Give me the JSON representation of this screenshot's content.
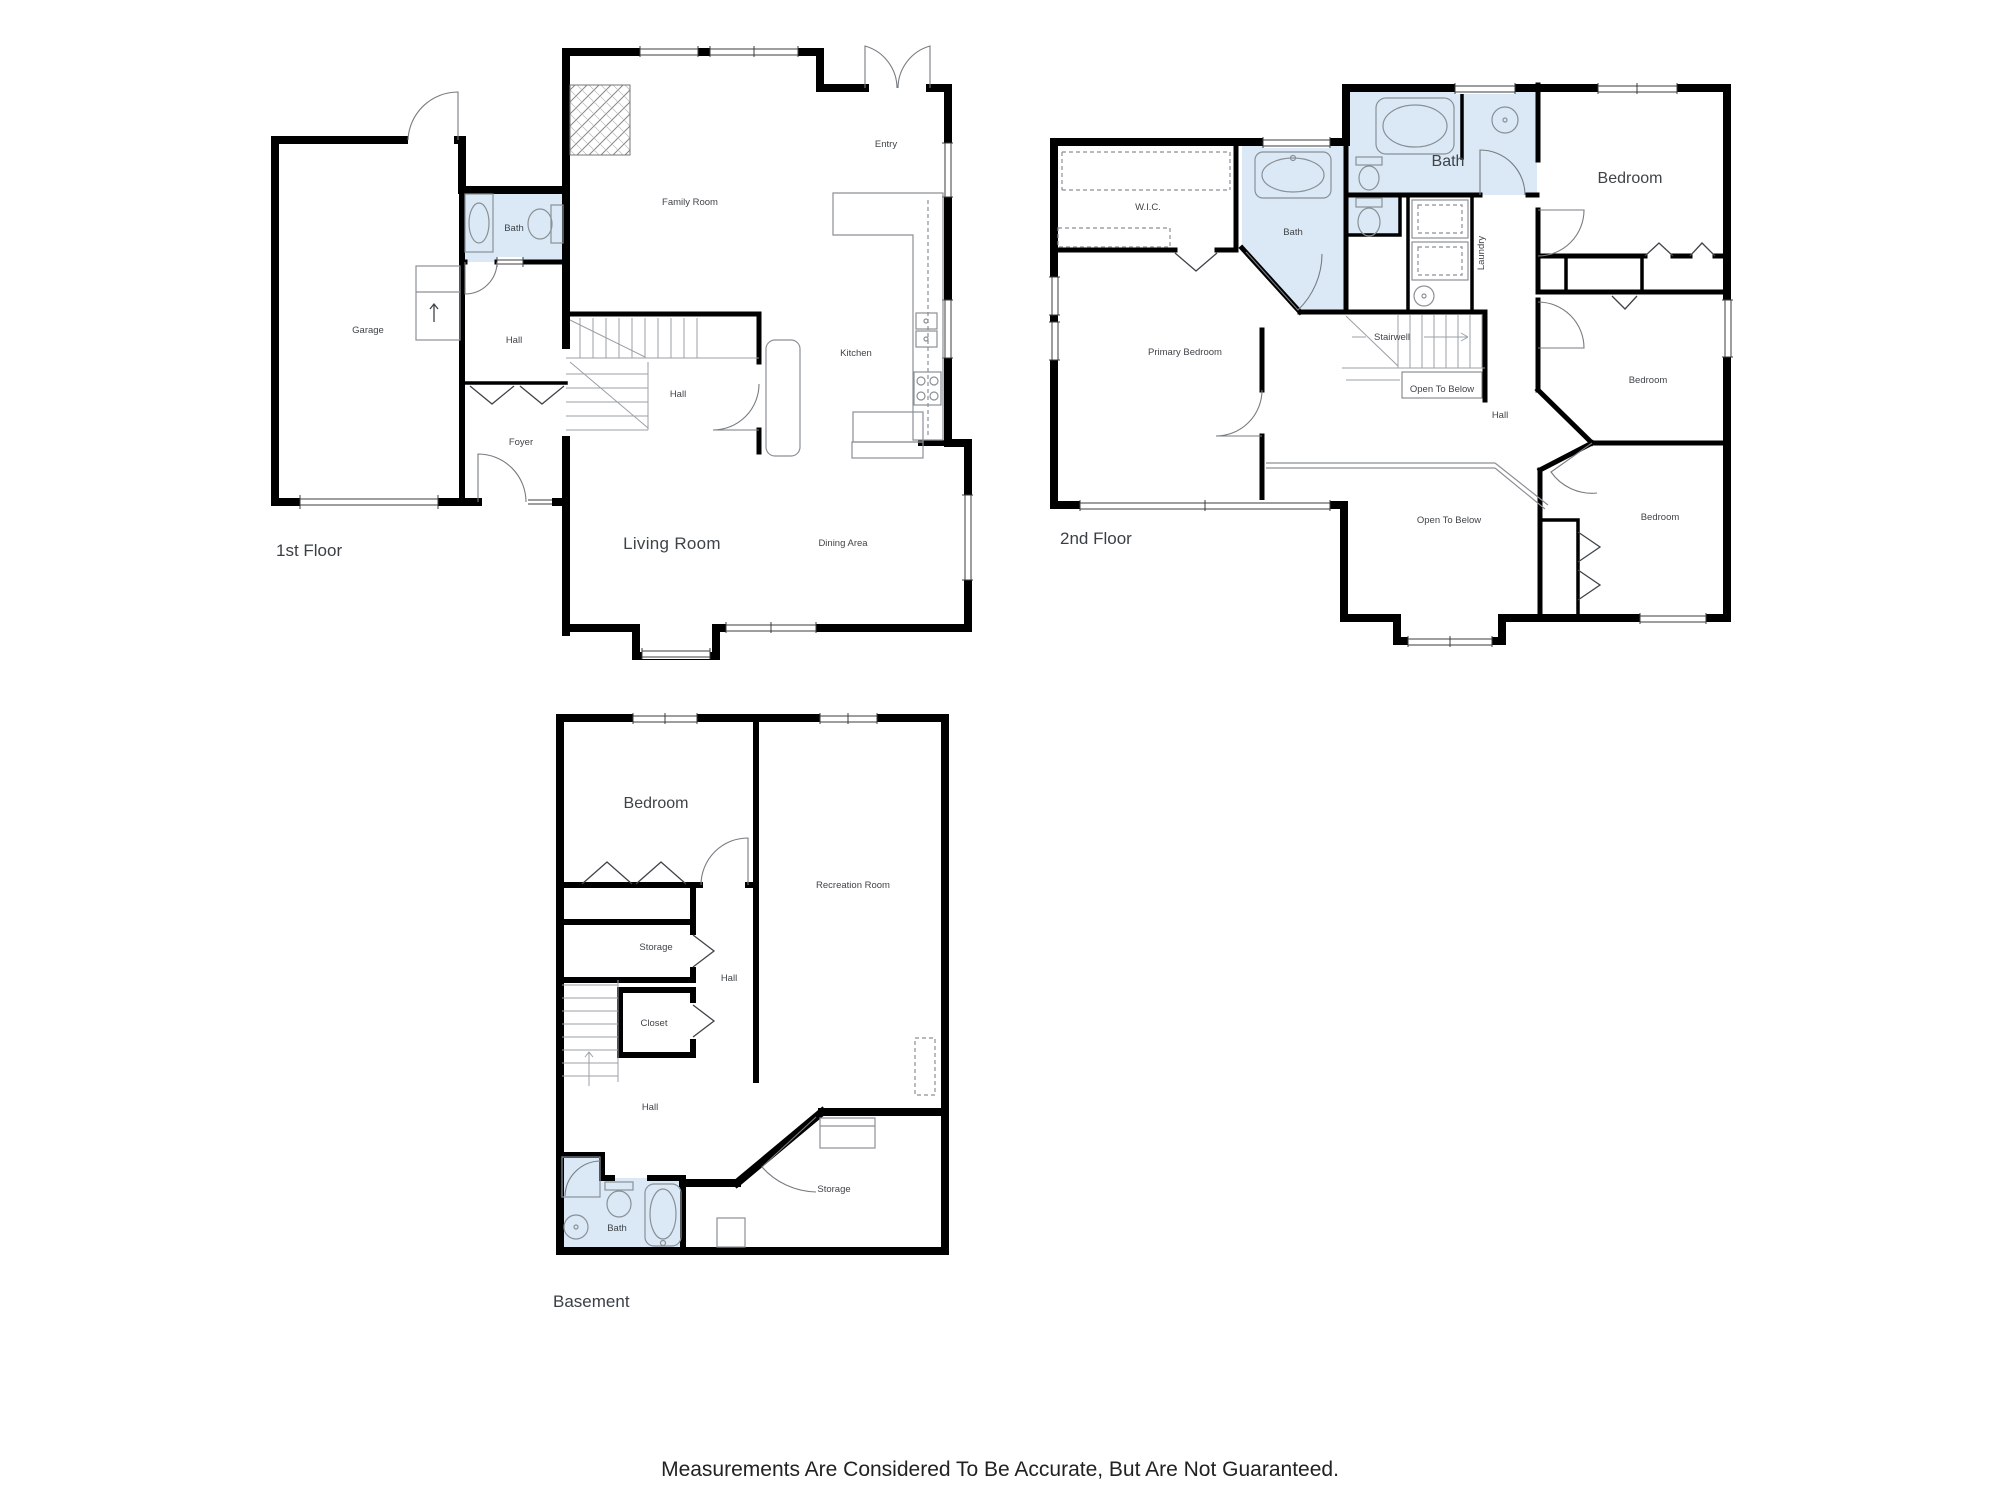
{
  "floors": {
    "first": {
      "title": "1st Floor",
      "rooms": {
        "garage": "Garage",
        "bath": "Bath",
        "hall_upper": "Hall",
        "family_room": "Family Room",
        "entry": "Entry",
        "kitchen": "Kitchen",
        "hall_lower": "Hall",
        "foyer": "Foyer",
        "living_room": "Living Room",
        "dining_area": "Dining Area"
      }
    },
    "second": {
      "title": "2nd Floor",
      "rooms": {
        "wic": "W.I.C.",
        "bath_primary": "Bath",
        "bath_hall": "Bath",
        "laundry": "Laundry",
        "stairwell": "Stairwell",
        "open_to_below_small": "Open To Below",
        "bedroom_top": "Bedroom",
        "primary_bedroom": "Primary Bedroom",
        "hall": "Hall",
        "bedroom_mid": "Bedroom",
        "open_to_below_large": "Open To Below",
        "bedroom_bottom": "Bedroom"
      }
    },
    "basement": {
      "title": "Basement",
      "rooms": {
        "bedroom": "Bedroom",
        "recreation_room": "Recreation Room",
        "storage_upper": "Storage",
        "hall_mid": "Hall",
        "closet": "Closet",
        "hall_lower": "Hall",
        "bath": "Bath",
        "storage_lower": "Storage"
      }
    }
  },
  "footer": {
    "disclaimer": "Measurements Are Considered To Be Accurate, But Are Not Guaranteed."
  },
  "colors": {
    "bath_fill": "#dbe9f6",
    "wall": "#000000",
    "label": "#3f4449"
  }
}
